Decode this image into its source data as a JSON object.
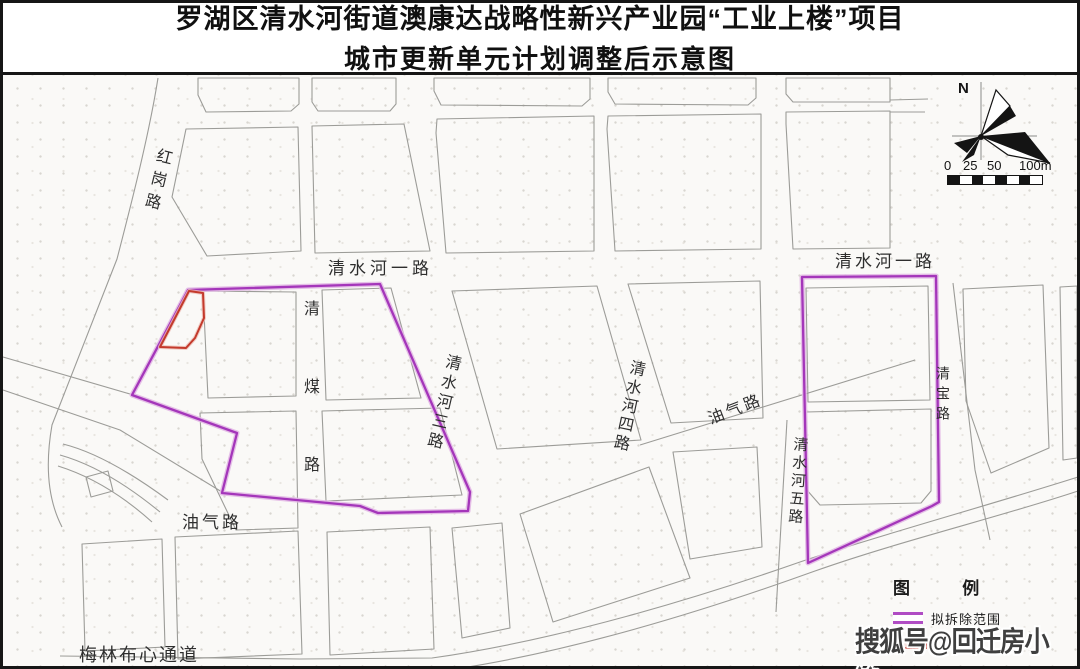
{
  "title": {
    "line1": "罗湖区清水河街道澳康达战略性新兴产业园“工业上楼”项目",
    "line2": "城市更新单元计划调整后示意图"
  },
  "map_labels": {
    "honggang_road": "红岗路",
    "qingshuihe_1_left": "清水河一路",
    "qingshuihe_1_right": "清水河一路",
    "qingmei_road": "清煤路",
    "qingshuihe_3": "清水河三路",
    "qingshuihe_4": "清水河四路",
    "qingshuihe_5": "清水河五路",
    "qingbao_road": "清宝路",
    "youqi_road_mid": "油气路",
    "youqi_road_left": "油气路",
    "meilin_buxin_corridor": "梅林布心通道"
  },
  "compass": {
    "north_label": "N"
  },
  "scale_bar": {
    "labels": [
      "0",
      "25",
      "50",
      "100m"
    ]
  },
  "legend": {
    "header": "图 例",
    "items": [
      {
        "label": "拟拆除范围",
        "color": "#b04cc4"
      },
      {
        "label": "",
        "color": "#cc4a42"
      }
    ]
  },
  "watermark": "搜狐号@回迁房小锋",
  "colors": {
    "demolition_outline": "#a436ba",
    "demolition_halo": "#e2b8e4",
    "red_parcel": "#c43a2c",
    "road_line": "#9c9c98",
    "map_background": "#faf9f7",
    "text": "#2e2e2e"
  }
}
